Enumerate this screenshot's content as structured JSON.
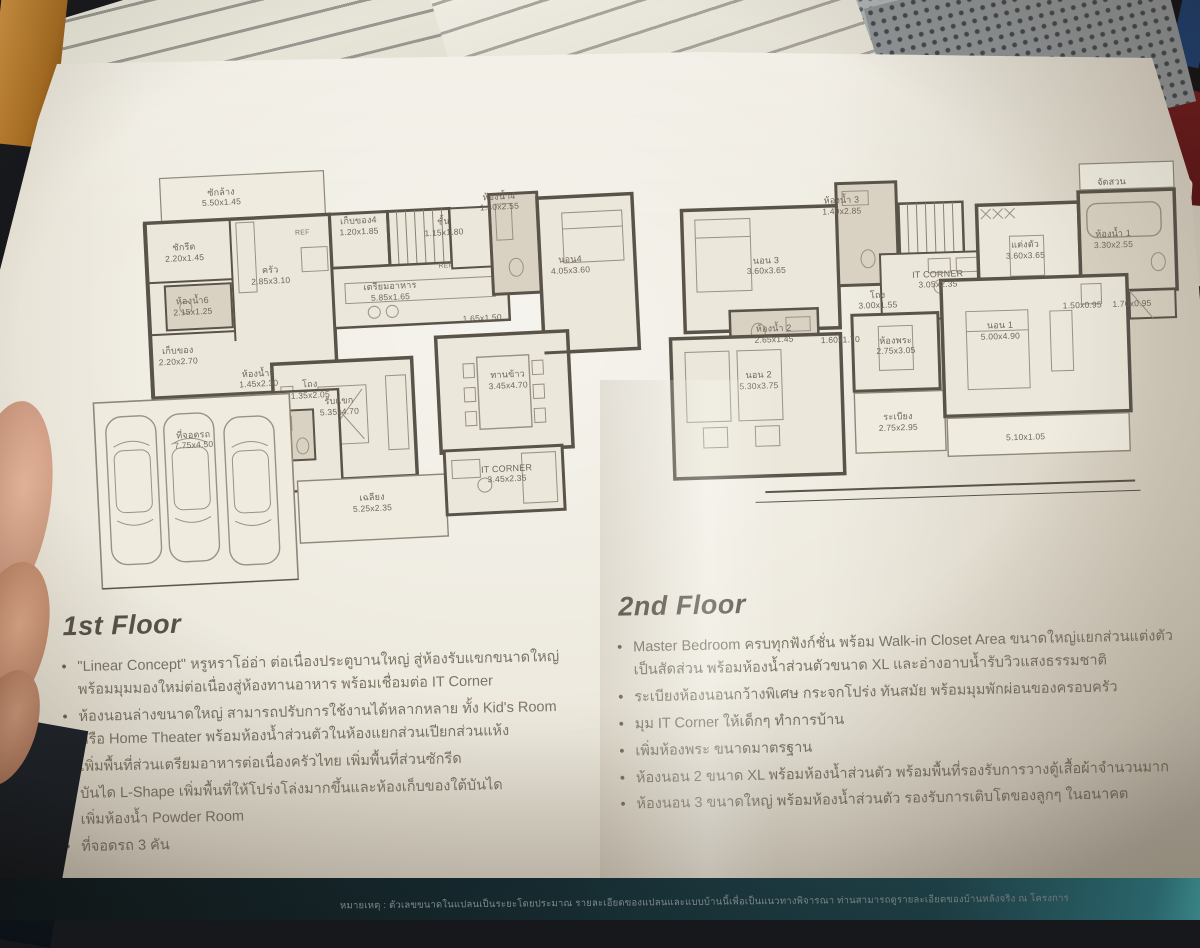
{
  "page": {
    "disclaimer": "หมายเหตุ : ตัวเลขขนาดในแปลนเป็นระยะโดยประมาณ รายละเอียดของแปลนและแบบบ้านนี้เพื่อเป็นแนวทางพิจารณา ท่านสามารถดูรายละเอียดของบ้านหลังจริง ณ โครงการ"
  },
  "colors": {
    "page": "#ece8dc",
    "plan_wall": "#59534a",
    "bath_fill": "#d9d2c2",
    "heading": "#57534a",
    "body_text": "#7b7565",
    "footer_teal": "#2f8794",
    "accent_red": "#8e2024"
  },
  "floors": [
    {
      "title": "1st Floor",
      "bullets": [
        "\"Linear Concept\" หรูหราโอ่อ่า ต่อเนื่องประตูบานใหญ่ สู่ห้องรับแขกขนาดใหญ่ พร้อมมุมมองใหม่ต่อเนื่องสู่ห้องทานอาหาร พร้อมเชื่อมต่อ IT Corner",
        "ห้องนอนล่างขนาดใหญ่ สามารถปรับการใช้งานได้หลากหลาย ทั้ง Kid's Room หรือ Home Theater พร้อมห้องน้ำส่วนตัวในห้องแยกส่วนเปียกส่วนแห้ง",
        "เพิ่มพื้นที่ส่วนเตรียมอาหารต่อเนื่องครัวไทย เพิ่มพื้นที่ส่วนซักรีด",
        "บันได L-Shape เพิ่มพื้นที่ให้โปร่งโล่งมากขึ้นและห้องเก็บของใต้บันได",
        "เพิ่มห้องน้ำ Powder Room",
        "ที่จอดรถ 3 คัน"
      ],
      "rooms": [
        {
          "label": "ซักล้าง",
          "dim": "5.50x1.45",
          "x": 27,
          "y": 8
        },
        {
          "label": "ซักรีด",
          "dim": "2.20x1.45",
          "x": 20,
          "y": 20
        },
        {
          "label": "ครัว",
          "dim": "2.85x3.10",
          "x": 35,
          "y": 26
        },
        {
          "label": "REF",
          "dim": "",
          "x": 41,
          "y": 17,
          "tiny": true
        },
        {
          "label": "เก็บของ4",
          "dim": "1.20x1.85",
          "x": 51,
          "y": 16
        },
        {
          "label": "ชั้น",
          "dim": "1.15x1.80",
          "x": 66,
          "y": 17
        },
        {
          "label": "ห้องน้ำ4",
          "dim": "1.40x2.55",
          "x": 76,
          "y": 12
        },
        {
          "label": "นอน4",
          "dim": "4.05x3.60",
          "x": 88,
          "y": 27
        },
        {
          "label": "",
          "dim": "1.65x1.50",
          "x": 72,
          "y": 38
        },
        {
          "label": "เตรียมอาหาร",
          "dim": "5.85x1.65",
          "x": 56,
          "y": 31
        },
        {
          "label": "REF",
          "dim": "",
          "x": 66,
          "y": 26,
          "tiny": true
        },
        {
          "label": "ห้องน้ำ6",
          "dim": "2.15x1.25",
          "x": 21,
          "y": 32
        },
        {
          "label": "เก็บของ",
          "dim": "2.20x2.70",
          "x": 18,
          "y": 43
        },
        {
          "label": "ห้องน้ำ5",
          "dim": "1.45x2.30",
          "x": 32,
          "y": 49
        },
        {
          "label": "โถง",
          "dim": "1.35x2.05",
          "x": 41,
          "y": 52
        },
        {
          "label": "รับแขก",
          "dim": "5.35x4.70",
          "x": 46,
          "y": 56
        },
        {
          "label": "ทานข้าว",
          "dim": "3.45x4.70",
          "x": 76,
          "y": 52
        },
        {
          "label": "ที่จอดรถ",
          "dim": "7.75x4.50",
          "x": 20,
          "y": 62
        },
        {
          "label": "เฉลียง",
          "dim": "5.25x2.35",
          "x": 51,
          "y": 78
        },
        {
          "label": "IT CORNER",
          "dim": "3.45x2.35",
          "x": 75,
          "y": 73
        }
      ]
    },
    {
      "title": "2nd Floor",
      "bullets": [
        "Master Bedroom ครบทุกฟังก์ชั่น พร้อม Walk-in Closet Area ขนาดใหญ่แยกส่วนแต่งตัวเป็นสัดส่วน พร้อมห้องน้ำส่วนตัวขนาด XL และอ่างอาบน้ำรับวิวแสงธรรมชาติ",
        "ระเบียงห้องนอนกว้างพิเศษ กระจกโปร่ง ทันสมัย พร้อมมุมพักผ่อนของครอบครัว",
        "มุม IT Corner ให้เด็กๆ ทำการบ้าน",
        "เพิ่มห้องพระ ขนาดมาตรฐาน",
        "ห้องนอน 2 ขนาด XL พร้อมห้องน้ำส่วนตัว พร้อมพื้นที่รองรับการวางตู้เสื้อผ้าจำนวนมาก",
        "ห้องนอน 3 ขนาดใหญ่ พร้อมห้องน้ำส่วนตัว รองรับการเติบโตของลูกๆ ในอนาคต"
      ],
      "rooms": [
        {
          "label": "นอน 3",
          "dim": "3.60x3.65",
          "x": 25,
          "y": 25
        },
        {
          "label": "ห้องน้ำ 3",
          "dim": "1.40x2.85",
          "x": 39,
          "y": 10
        },
        {
          "label": "จัดสวน",
          "dim": "",
          "x": 88,
          "y": 6
        },
        {
          "label": "แต่งตัว",
          "dim": "3.60x3.65",
          "x": 72,
          "y": 23
        },
        {
          "label": "ห้องน้ำ 1",
          "dim": "3.30x2.55",
          "x": 88,
          "y": 21
        },
        {
          "label": "โถง",
          "dim": "3.00x1.55",
          "x": 45,
          "y": 35
        },
        {
          "label": "IT CORNER",
          "dim": "3.05x2.35",
          "x": 56,
          "y": 30
        },
        {
          "label": "ห้องน้ำ 2",
          "dim": "2.65x1.45",
          "x": 26,
          "y": 43
        },
        {
          "label": "",
          "dim": "1.60x1.70",
          "x": 38,
          "y": 45
        },
        {
          "label": "ห้องพระ",
          "dim": "2.75x3.05",
          "x": 48,
          "y": 47
        },
        {
          "label": "",
          "dim": "1.50x0.95",
          "x": 82,
          "y": 38
        },
        {
          "label": "",
          "dim": "1.70x0.95",
          "x": 91,
          "y": 38
        },
        {
          "label": "นอน 2",
          "dim": "5.30x3.75",
          "x": 23,
          "y": 55
        },
        {
          "label": "ระเบียง",
          "dim": "2.75x2.95",
          "x": 48,
          "y": 67
        },
        {
          "label": "นอน 1",
          "dim": "5.00x4.90",
          "x": 67,
          "y": 44
        },
        {
          "label": "",
          "dim": "5.10x1.05",
          "x": 71,
          "y": 72
        }
      ]
    }
  ]
}
